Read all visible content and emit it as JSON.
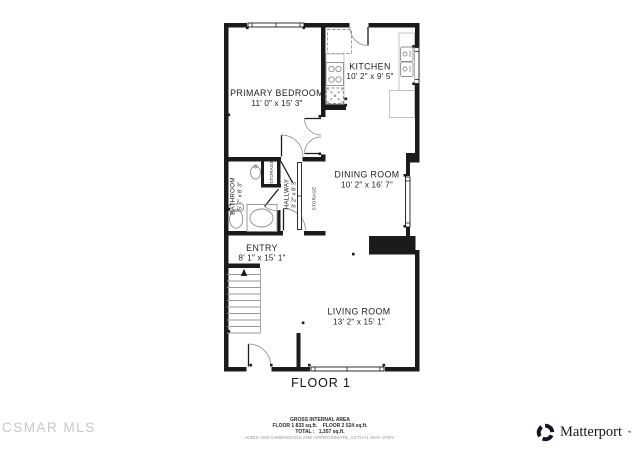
{
  "colors": {
    "wall": "#1b1b1b",
    "fixture_line": "#8d8d8d",
    "arc_line": "#9a9a9a",
    "watermark": "#c7c7c7",
    "brand": "#16151f"
  },
  "floor_plan": {
    "floor_label": "FLOOR 1",
    "rooms": {
      "primary_bedroom": {
        "name": "PRIMARY BEDROOM",
        "dims": "11' 0\" x 15' 3\""
      },
      "kitchen": {
        "name": "KITCHEN",
        "dims": "10' 2\" x 9' 5\""
      },
      "dining_room": {
        "name": "DINING ROOM",
        "dims": "10' 2\" x 16' 7\""
      },
      "living_room": {
        "name": "LIVING ROOM",
        "dims": "13' 2\" x 15' 1\""
      },
      "entry": {
        "name": "ENTRY",
        "dims": "8' 1\" x 15' 1\""
      },
      "bathroom": {
        "name": "BATHROOM",
        "dims": "5' 7\" x 8' 3\""
      },
      "hallway": {
        "name": "HALLWAY",
        "dims": "3' 2\" x 8' 3\""
      },
      "storage_bath": {
        "name": "STORAGE"
      },
      "storage_hall": {
        "name": "STORAGE"
      }
    }
  },
  "footer": {
    "area_title": "GROSS INTERNAL AREA",
    "area_line1": "FLOOR 1 833 sq.ft.    FLOOR 2 524 sq.ft.",
    "area_line2": "TOTAL :   1,357 sq.ft.",
    "disclaimer": "SIZES AND DIMENSIONS ARE APPROXIMATE, ACTUAL MAY VARY."
  },
  "watermark": "CSMAR MLS",
  "brand": {
    "name": "Matterport",
    "mark": "™"
  }
}
